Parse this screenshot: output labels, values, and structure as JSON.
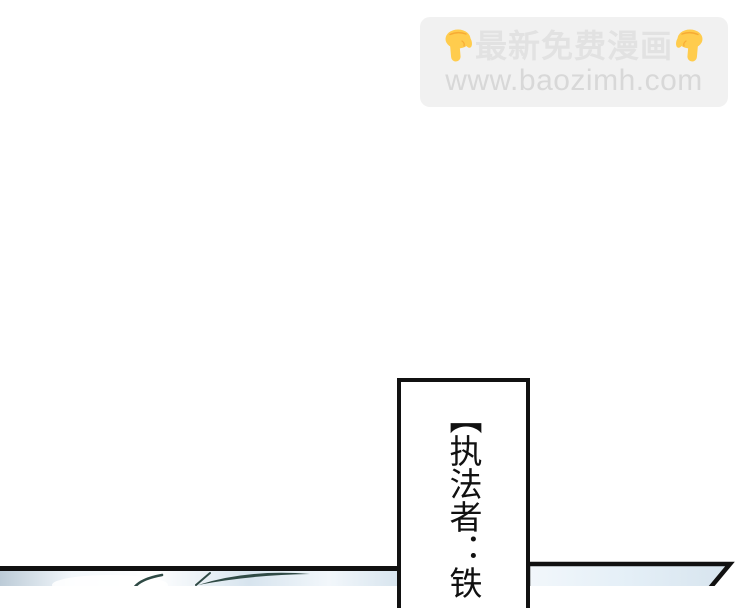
{
  "watermark": {
    "line1": "最新免费漫画",
    "line2": "www.baozimh.com",
    "hand_icon": "backhand-index-pointing-down"
  },
  "dialogue": {
    "text": "【执法者：铁"
  },
  "theme": {
    "ink": "#111111",
    "watermark_bg": "#f1f1f1",
    "watermark_text": "#e2e2e2",
    "url_text": "#d8d8d8",
    "emoji_yellow": "#ffcc4d",
    "emoji_shade": "#f19020",
    "sky_dark": "#bccbd7",
    "sky_mid": "#d7e4ee",
    "sky_light": "#f2f7fb",
    "grass_teal": "#2f4a45",
    "page_bg": "#ffffff"
  }
}
